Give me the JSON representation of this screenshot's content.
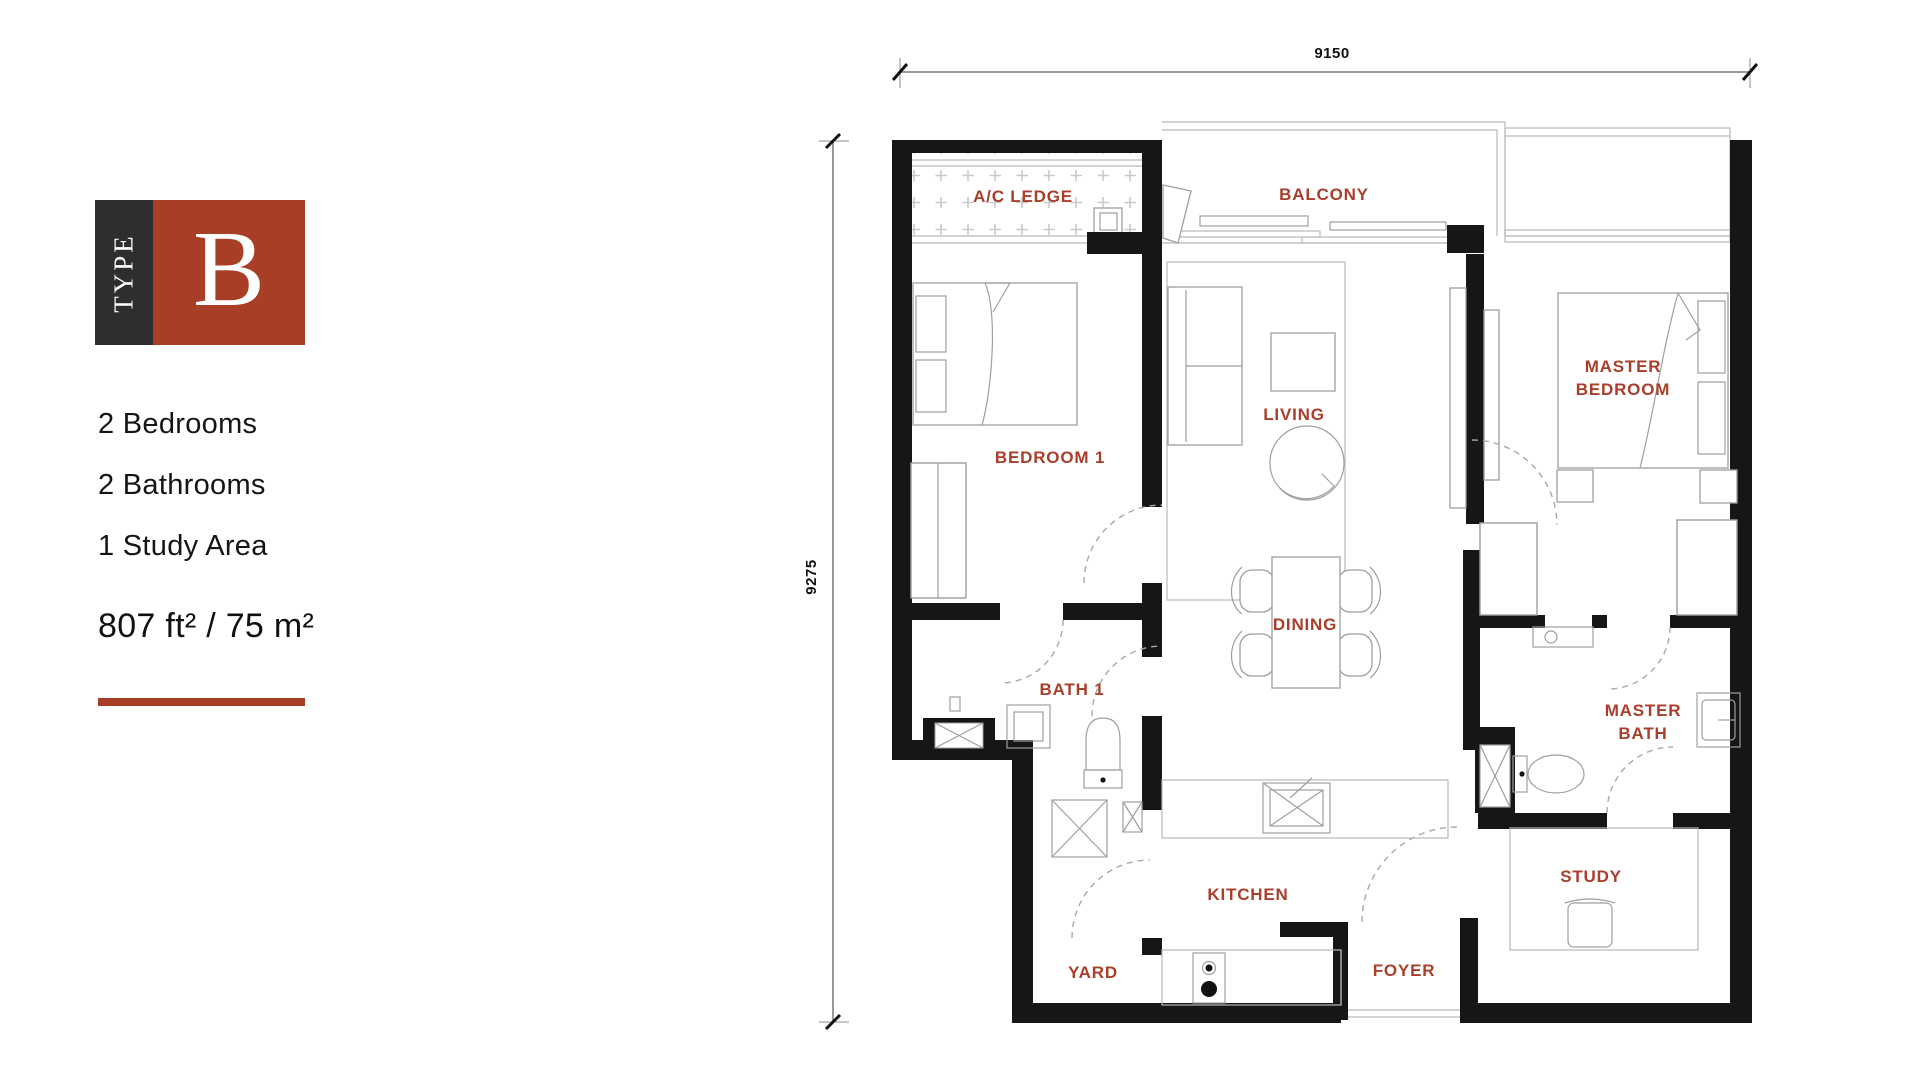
{
  "colors": {
    "accent": "#a93e27",
    "label": "#a93e2b",
    "wall": "#161616",
    "dim_line": "#9a9a9a"
  },
  "badge": {
    "type_label": "TYPE",
    "letter": "B"
  },
  "info": {
    "items": [
      {
        "label": "2 Bedrooms"
      },
      {
        "label": "2 Bathrooms"
      },
      {
        "label": "1 Study Area"
      }
    ],
    "area_label": "807 ft² / 75 m²"
  },
  "floorplan": {
    "dimensions": {
      "width_label": "9150",
      "height_label": "9275"
    },
    "rooms": {
      "ac_ledge": "A/C LEDGE",
      "balcony": "BALCONY",
      "bedroom1": "BEDROOM 1",
      "living": "LIVING",
      "master_bedroom": [
        "MASTER",
        "BEDROOM"
      ],
      "dining": "DINING",
      "bath1": "BATH 1",
      "master_bath": [
        "MASTER",
        "BATH"
      ],
      "kitchen": "KITCHEN",
      "yard": "YARD",
      "foyer": "FOYER",
      "study": "STUDY"
    }
  }
}
